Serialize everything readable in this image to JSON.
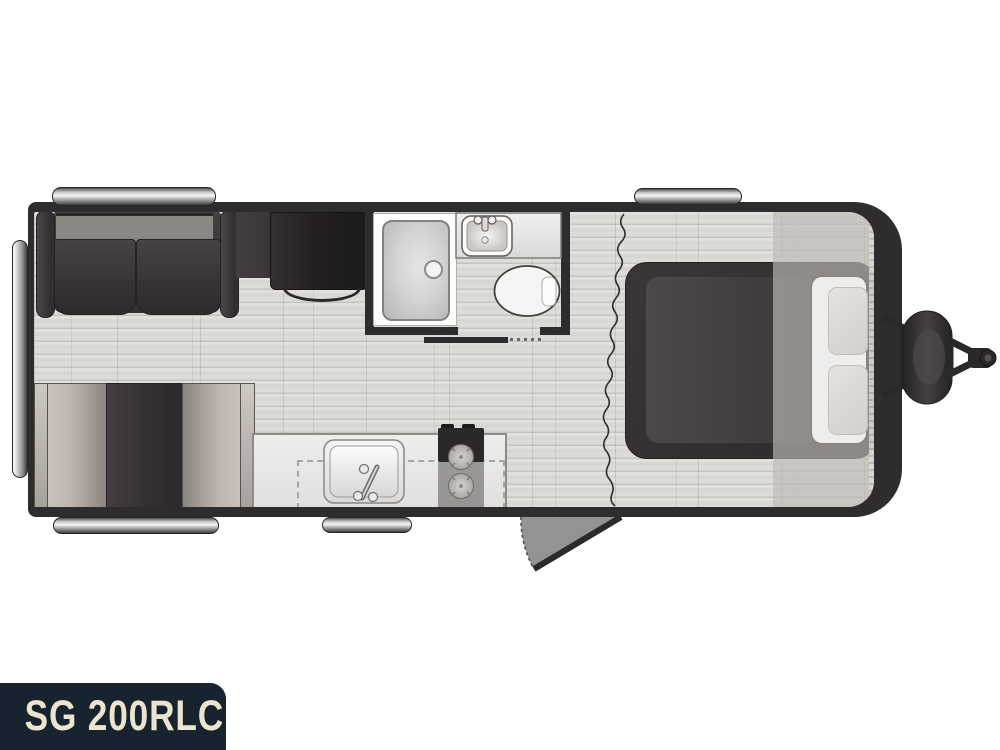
{
  "model_plate": {
    "text": "SG 200RLC"
  },
  "colors": {
    "label_bg": "#17232e",
    "label_text": "#ebe5cf",
    "wall": "#2f2c2d",
    "dark_furniture": "#353132",
    "counter": "#eae8e6",
    "fixture": "#f5f4f3"
  },
  "features": [
    "rear-sofa",
    "tv-cabinet",
    "tv",
    "shower",
    "bathroom-vanity-sink",
    "toilet",
    "pocket-door",
    "curtain-divider",
    "bed",
    "pillows",
    "front-wardrobe-band",
    "booth-dinette",
    "kitchen-counter",
    "kitchen-sink",
    "two-burner-cooktop",
    "counter-extension-dashed",
    "entry-door-swing",
    "awning-rails",
    "rear-bumper",
    "a-frame-tongue",
    "propane-tank",
    "hitch-coupler"
  ]
}
